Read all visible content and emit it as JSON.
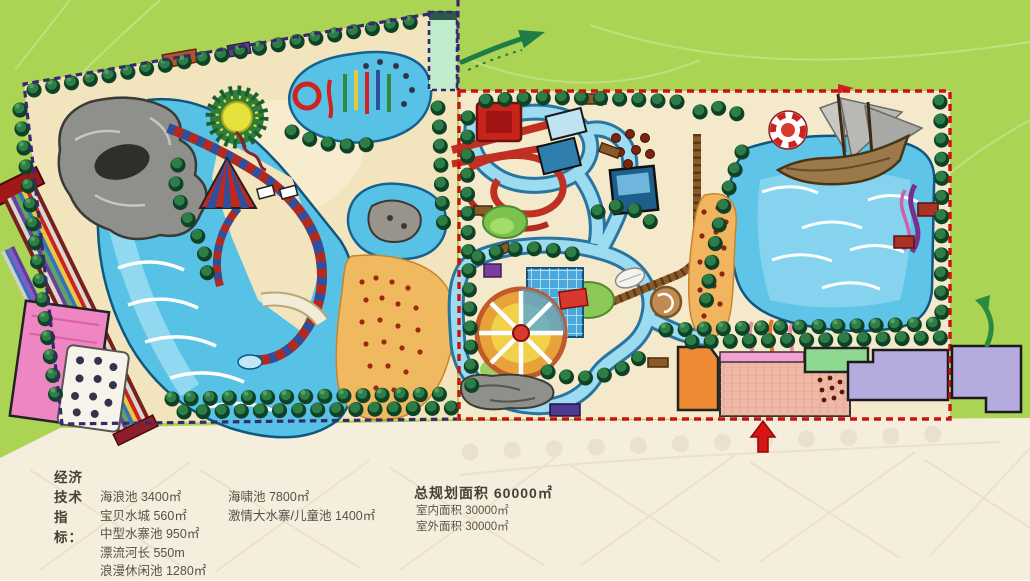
{
  "legend": {
    "heading": "经济技术指标：",
    "col1": [
      "海浪池 3400㎡",
      "宝贝水城 560㎡",
      "中型水寨池 950㎡",
      "漂流河长 550m",
      "浪漫休闲池 1280㎡"
    ],
    "col2": [
      "海啸池 7800㎡",
      "激情大水寨/儿童池 1400㎡"
    ],
    "summary": [
      "总规划面积 60000㎡",
      "室内面积 30000㎡",
      "室外面积 30000㎡"
    ]
  },
  "colors": {
    "background_green": "#abd455",
    "ground_beige": "#f6eedd",
    "site_sand": "#f2e4bd",
    "pool_blue": "#58c2e6",
    "left_zone_boundary": "#38286e",
    "right_zone_boundary": "#cc1111",
    "entrance_arrow": "#d81414"
  }
}
